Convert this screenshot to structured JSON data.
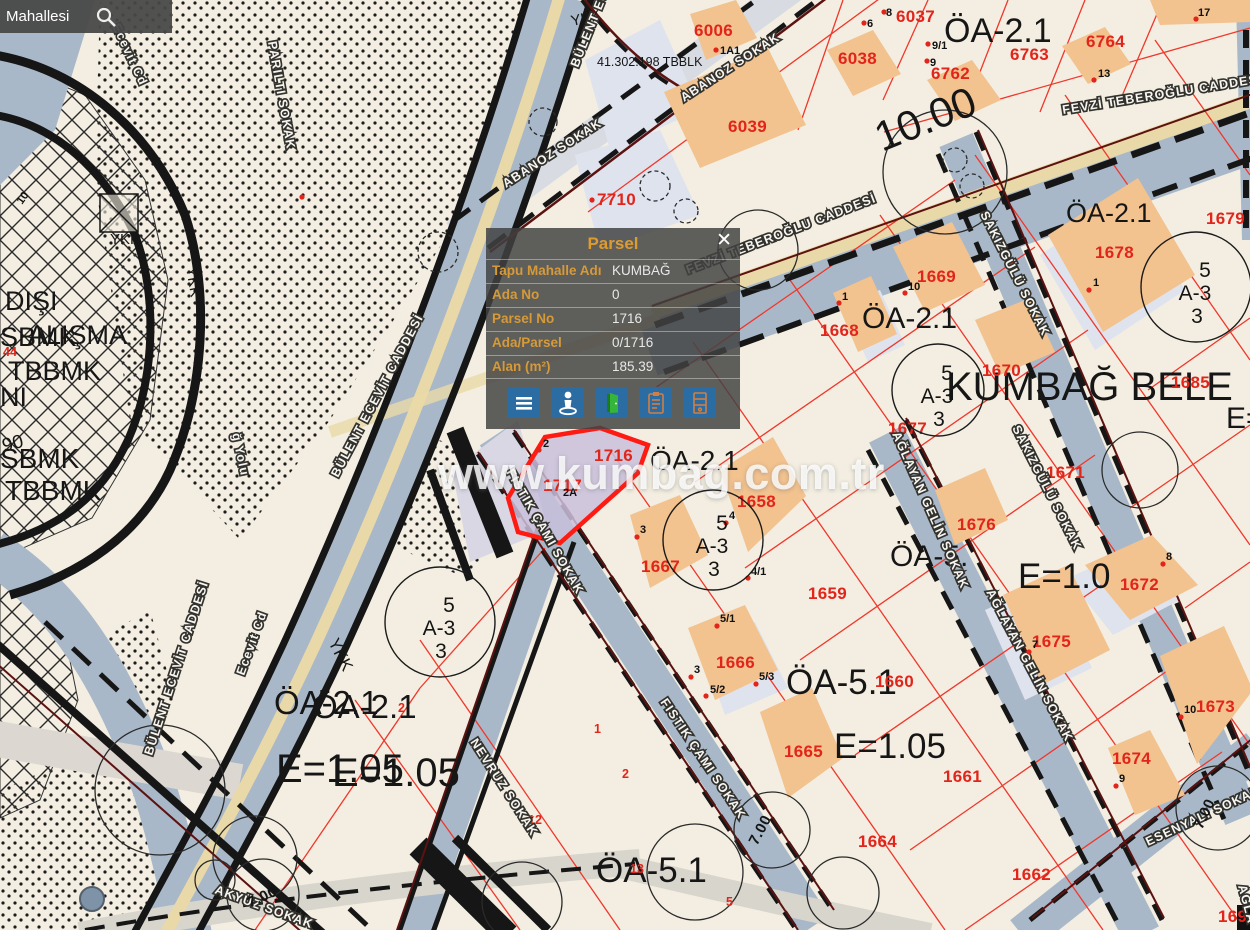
{
  "search": {
    "value": "Mahallesi"
  },
  "popup": {
    "title": "Parsel",
    "close": "✕",
    "fields": [
      {
        "label": "Tapu Mahalle Adı",
        "value": "KUMBAĞ"
      },
      {
        "label": "Ada No",
        "value": "0"
      },
      {
        "label": "Parsel No",
        "value": "1716"
      },
      {
        "label": "Ada/Parsel",
        "value": "0/1716"
      },
      {
        "label": "Alan (m²)",
        "value": "185.39"
      }
    ],
    "buttons": [
      {
        "name": "menu-icon"
      },
      {
        "name": "street-view-icon"
      },
      {
        "name": "door-green-icon"
      },
      {
        "name": "clipboard-icon"
      },
      {
        "name": "cabinet-icon"
      }
    ]
  },
  "watermark": "www.kumbag.com.tr",
  "map": {
    "parcel_numbers": [
      {
        "t": "6006",
        "x": 694,
        "y": 36
      },
      {
        "t": "6037",
        "x": 896,
        "y": 22
      },
      {
        "t": "6038",
        "x": 838,
        "y": 64
      },
      {
        "t": "6762",
        "x": 931,
        "y": 79
      },
      {
        "t": "6763",
        "x": 1010,
        "y": 60
      },
      {
        "t": "6764",
        "x": 1086,
        "y": 47
      },
      {
        "t": "6039",
        "x": 728,
        "y": 132
      },
      {
        "t": "7710",
        "x": 597,
        "y": 205
      },
      {
        "t": "1669",
        "x": 917,
        "y": 282
      },
      {
        "t": "1668",
        "x": 820,
        "y": 336
      },
      {
        "t": "1678",
        "x": 1095,
        "y": 258
      },
      {
        "t": "1679",
        "x": 1206,
        "y": 224
      },
      {
        "t": "1670",
        "x": 982,
        "y": 376
      },
      {
        "t": "1677",
        "x": 888,
        "y": 434
      },
      {
        "t": "1685",
        "x": 1171,
        "y": 388
      },
      {
        "t": "1671",
        "x": 1046,
        "y": 478
      },
      {
        "t": "1716",
        "x": 594,
        "y": 461
      },
      {
        "t": "1717",
        "x": 543,
        "y": 491
      },
      {
        "t": "1658",
        "x": 737,
        "y": 507
      },
      {
        "t": "1676",
        "x": 957,
        "y": 530
      },
      {
        "t": "1667",
        "x": 641,
        "y": 572
      },
      {
        "t": "1659",
        "x": 808,
        "y": 599
      },
      {
        "t": "1672",
        "x": 1120,
        "y": 590
      },
      {
        "t": "1675",
        "x": 1032,
        "y": 647
      },
      {
        "t": "1673",
        "x": 1196,
        "y": 712
      },
      {
        "t": "1674",
        "x": 1112,
        "y": 764
      },
      {
        "t": "1660",
        "x": 875,
        "y": 687
      },
      {
        "t": "1666",
        "x": 716,
        "y": 668
      },
      {
        "t": "1665",
        "x": 784,
        "y": 757
      },
      {
        "t": "1661",
        "x": 943,
        "y": 782
      },
      {
        "t": "1664",
        "x": 858,
        "y": 847
      },
      {
        "t": "1662",
        "x": 1012,
        "y": 880
      },
      {
        "t": "1694",
        "x": 1218,
        "y": 922
      }
    ],
    "lot_numbers_red": [
      {
        "t": "1",
        "x": 594,
        "y": 733
      },
      {
        "t": "2",
        "x": 398,
        "y": 712
      },
      {
        "t": "2",
        "x": 622,
        "y": 778
      },
      {
        "t": "5",
        "x": 726,
        "y": 906
      },
      {
        "t": "12",
        "x": 528,
        "y": 824
      },
      {
        "t": "13",
        "x": 630,
        "y": 873
      },
      {
        "t": "44",
        "x": 3,
        "y": 356
      }
    ],
    "point_labels": [
      {
        "t": "1A1",
        "x": 720,
        "y": 54
      },
      {
        "t": "8",
        "x": 886,
        "y": 16
      },
      {
        "t": "6",
        "x": 867,
        "y": 27
      },
      {
        "t": "9/1",
        "x": 932,
        "y": 49
      },
      {
        "t": "9",
        "x": 930,
        "y": 66
      },
      {
        "t": "13",
        "x": 1098,
        "y": 77
      },
      {
        "t": "17",
        "x": 1198,
        "y": 16
      },
      {
        "t": "10",
        "x": 908,
        "y": 290
      },
      {
        "t": "1",
        "x": 842,
        "y": 300
      },
      {
        "t": "1",
        "x": 1093,
        "y": 286
      },
      {
        "t": "2",
        "x": 543,
        "y": 447
      },
      {
        "t": "2A",
        "x": 563,
        "y": 496
      },
      {
        "t": "3",
        "x": 640,
        "y": 533
      },
      {
        "t": "4",
        "x": 729,
        "y": 519
      },
      {
        "t": "4/1",
        "x": 751,
        "y": 575
      },
      {
        "t": "5/1",
        "x": 720,
        "y": 622
      },
      {
        "t": "5/2",
        "x": 710,
        "y": 693
      },
      {
        "t": "5/3",
        "x": 759,
        "y": 680
      },
      {
        "t": "3",
        "x": 694,
        "y": 673
      },
      {
        "t": "7",
        "x": 1032,
        "y": 648
      },
      {
        "t": "8",
        "x": 1166,
        "y": 560
      },
      {
        "t": "10",
        "x": 1184,
        "y": 713
      },
      {
        "t": "9",
        "x": 1119,
        "y": 782
      },
      {
        "t": "10",
        "x": 22,
        "y": 205,
        "r": -55
      }
    ],
    "red_dots": [
      [
        716,
        50
      ],
      [
        884,
        12
      ],
      [
        864,
        23
      ],
      [
        928,
        44
      ],
      [
        927,
        61
      ],
      [
        1094,
        80
      ],
      [
        1196,
        19
      ],
      [
        905,
        293
      ],
      [
        839,
        303
      ],
      [
        1089,
        290
      ],
      [
        539,
        450
      ],
      [
        637,
        537
      ],
      [
        726,
        523
      ],
      [
        748,
        578
      ],
      [
        717,
        626
      ],
      [
        706,
        696
      ],
      [
        756,
        684
      ],
      [
        691,
        677
      ],
      [
        1029,
        652
      ],
      [
        1163,
        564
      ],
      [
        1181,
        717
      ],
      [
        1116,
        786
      ],
      [
        592,
        200
      ],
      [
        302,
        197
      ]
    ],
    "zone_labels": [
      {
        "t": "ÖA-2.1",
        "x": 944,
        "y": 42,
        "s": 34
      },
      {
        "t": "ÖA-2.1",
        "x": 1066,
        "y": 222,
        "s": 27
      },
      {
        "t": "ÖA-2.1",
        "x": 862,
        "y": 328,
        "s": 30
      },
      {
        "t": "ÖA-2.1",
        "x": 650,
        "y": 470,
        "s": 28
      },
      {
        "t": "ÖA-2.1",
        "x": 274,
        "y": 714,
        "s": 33
      },
      {
        "t": "ÖA-2.1",
        "x": 312,
        "y": 718,
        "s": 33
      },
      {
        "t": "E=1.05",
        "x": 276,
        "y": 782,
        "s": 40
      },
      {
        "t": "E=1.05",
        "x": 332,
        "y": 786,
        "s": 40
      },
      {
        "t": "E=1.05",
        "x": 834,
        "y": 758,
        "s": 35
      },
      {
        "t": "E=1.0",
        "x": 1018,
        "y": 588,
        "s": 35
      },
      {
        "t": "E=",
        "x": 1226,
        "y": 428,
        "s": 30
      },
      {
        "t": "ÖA-5.1",
        "x": 786,
        "y": 694,
        "s": 35
      },
      {
        "t": "ÖA-5.1",
        "x": 596,
        "y": 882,
        "s": 35
      },
      {
        "t": "ÖA-5.",
        "x": 890,
        "y": 566,
        "s": 30
      },
      {
        "t": "KUMBAĞ BELE",
        "x": 946,
        "y": 400,
        "s": 40
      },
      {
        "t": "10.00",
        "x": 882,
        "y": 152,
        "s": 42,
        "r": -22
      },
      {
        "t": "41.302.198 TBBLK",
        "x": 597,
        "y": 66,
        "s": 12.5
      },
      {
        "t": "DIŞI",
        "x": 5,
        "y": 310,
        "s": 27
      },
      {
        "t": "SBMK",
        "x": 0,
        "y": 346,
        "s": 27
      },
      {
        "t": "ALIŞMA",
        "x": 28,
        "y": 344,
        "s": 27
      },
      {
        "t": "TBBMK",
        "x": 8,
        "y": 380,
        "s": 27
      },
      {
        "t": "NI",
        "x": 0,
        "y": 406,
        "s": 27
      },
      {
        "t": "90",
        "x": 4,
        "y": 452,
        "s": 19,
        "r": -15
      },
      {
        "t": "SBMK",
        "x": 0,
        "y": 468,
        "s": 28
      },
      {
        "t": "TBBMK",
        "x": 5,
        "y": 500,
        "s": 28
      },
      {
        "t": "YKK",
        "x": 110,
        "y": 244,
        "s": 15
      },
      {
        "t": "YKK",
        "x": 186,
        "y": 268,
        "s": 15,
        "r": 80
      },
      {
        "t": "YKK",
        "x": 328,
        "y": 642,
        "s": 17,
        "r": 63
      },
      {
        "t": "YKK",
        "x": 572,
        "y": 26,
        "s": 15,
        "r": -12
      }
    ],
    "street_labels": [
      {
        "t": "ABANOZ SOKAK",
        "x": 684,
        "y": 102,
        "r": -33
      },
      {
        "t": "ABANOZ SOKAK",
        "x": 506,
        "y": 188,
        "r": -33
      },
      {
        "t": "FEVZİ TEBEROĞLU CADDESİ",
        "x": 1063,
        "y": 114,
        "r": -9,
        "s": 14
      },
      {
        "t": "FEVZİ TEBEROĞLU CADDESİ",
        "x": 688,
        "y": 274,
        "r": -21,
        "s": 14
      },
      {
        "t": "BÜLENT ECEVİT CADDESİ",
        "x": 338,
        "y": 478,
        "r": -62,
        "s": 13.5
      },
      {
        "t": "BÜLENT ECEVİT CADDESİ",
        "x": 152,
        "y": 756,
        "r": -72
      },
      {
        "t": "BÜLENT ECEVİT CADDESİ",
        "x": 578,
        "y": 68,
        "r": -68
      },
      {
        "t": "SAKIZGÜLÜ SOKAK",
        "x": 980,
        "y": 214,
        "r": 63,
        "s": 12
      },
      {
        "t": "SAKIZGÜLÜ SOKAK",
        "x": 1012,
        "y": 428,
        "r": 63,
        "s": 12
      },
      {
        "t": "FISTIK ÇAMI SOKAK",
        "x": 506,
        "y": 472,
        "r": 60,
        "s": 12
      },
      {
        "t": "FISTIK ÇAMI SOKAK",
        "x": 660,
        "y": 702,
        "r": 56,
        "s": 12
      },
      {
        "t": "AĞLAYAN GELİN SOKAK",
        "x": 892,
        "y": 434,
        "r": 66,
        "s": 11.5
      },
      {
        "t": "AĞLAYAN GELİN SOKAK",
        "x": 986,
        "y": 592,
        "r": 62,
        "s": 11.5
      },
      {
        "t": "ESENYALI SOKAK",
        "x": 1148,
        "y": 846,
        "r": -25,
        "s": 12
      },
      {
        "t": "NEVRUZ SOKAK",
        "x": 470,
        "y": 742,
        "r": 57,
        "s": 12
      },
      {
        "t": "AKYÜZ SOKAK",
        "x": 214,
        "y": 893,
        "r": 20,
        "s": 12
      },
      {
        "t": "PARILTI SOKAK",
        "x": 268,
        "y": 42,
        "r": 80,
        "s": 12
      },
      {
        "t": "Ecevit Cd",
        "x": 112,
        "y": 26,
        "r": 65,
        "s": 11
      },
      {
        "t": "Ecevit Cd",
        "x": 244,
        "y": 676,
        "r": -70,
        "s": 11
      },
      {
        "t": "ğ Yolu",
        "x": 232,
        "y": 434,
        "r": 78,
        "s": 11
      },
      {
        "t": "AĞLA",
        "x": 1238,
        "y": 886,
        "r": 75,
        "s": 12
      }
    ],
    "zoning_circles": [
      {
        "cx": 440,
        "cy": 622,
        "r": 55,
        "lines": [
          "5",
          "A-3",
          "3"
        ]
      },
      {
        "cx": 713,
        "cy": 540,
        "r": 50,
        "lines": [
          "5",
          "A-3",
          "3"
        ]
      },
      {
        "cx": 938,
        "cy": 390,
        "r": 46,
        "lines": [
          "5",
          "A-3",
          "3"
        ]
      },
      {
        "cx": 1196,
        "cy": 287,
        "r": 55,
        "lines": [
          "5",
          "A-3",
          "3"
        ]
      }
    ],
    "road_width_labels": [
      {
        "t": "7.00",
        "x": 757,
        "y": 846,
        "r": -62
      },
      {
        "t": "7.00",
        "x": 1202,
        "y": 830,
        "r": -65
      },
      {
        "t": "7.00",
        "x": 250,
        "y": 908,
        "r": -25
      }
    ]
  }
}
